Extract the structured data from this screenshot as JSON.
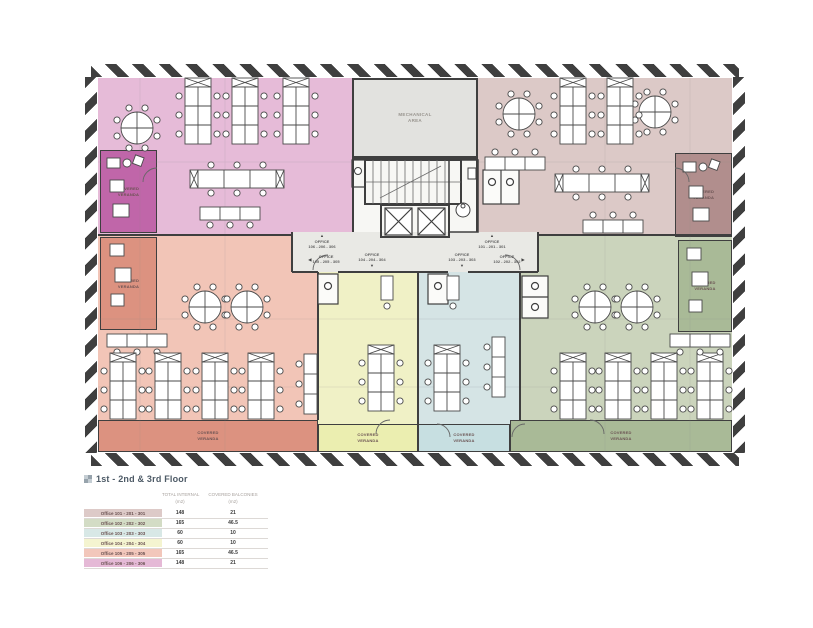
{
  "plan": {
    "mechanical_label": "MECHANICAL\nAREA",
    "veranda_label": "COVERED\nVERANDA",
    "surfaces": {
      "mechanical": "#e2e2df",
      "corridor": "#e9e9e5",
      "core": "#f7f7f4"
    },
    "zones": {
      "office101": {
        "color": "#dcc9c7",
        "veranda": "#b18e8d"
      },
      "office102": {
        "color": "#cbd4bc",
        "veranda": "#a9ba97"
      },
      "office103": {
        "color": "#d5e4e5",
        "veranda": "#c7dfe1"
      },
      "office104": {
        "color": "#f0f1c6",
        "veranda": "#ebeeb0"
      },
      "office105": {
        "color": "#f2c5b7",
        "veranda": "#dc9280"
      },
      "office106": {
        "color": "#e6bbd8",
        "veranda": "#c066a9"
      }
    },
    "directions": [
      {
        "name": "office-106",
        "text": "OFFICE\n106 - 206 - 306",
        "arrow": "▲"
      },
      {
        "name": "office-101",
        "text": "OFFICE\n101 - 201 - 301",
        "arrow": "▲"
      },
      {
        "name": "office-105",
        "text": "OFFICE\n105 - 205 - 305",
        "arrow": "◀"
      },
      {
        "name": "office-104",
        "text": "OFFICE\n104 - 204 - 304",
        "arrow": "▼"
      },
      {
        "name": "office-103",
        "text": "OFFICE\n103 - 203 - 303",
        "arrow": "▼"
      },
      {
        "name": "office-102",
        "text": "OFFICE\n102 - 202 - 302",
        "arrow": "▶"
      }
    ]
  },
  "legend": {
    "title": "1st - 2nd & 3rd Floor",
    "columns": [
      {
        "label": "TOTAL INTERNAL",
        "unit": "(m2)"
      },
      {
        "label": "COVERED BALCONIES",
        "unit": "(m2)"
      }
    ],
    "rows": [
      {
        "label": "Office 101 - 201 - 301",
        "internal": "148",
        "balconies": "21",
        "color": "#ddcac8"
      },
      {
        "label": "Office 102 - 202 - 302",
        "internal": "165",
        "balconies": "46.5",
        "color": "#d3dcc5"
      },
      {
        "label": "Office 103 - 203 - 303",
        "internal": "60",
        "balconies": "10",
        "color": "#d8e8e6"
      },
      {
        "label": "Office 104 - 204 - 304",
        "internal": "60",
        "balconies": "10",
        "color": "#f4f4d0"
      },
      {
        "label": "Office 105 - 205 - 305",
        "internal": "165",
        "balconies": "46.5",
        "color": "#f2c7bb"
      },
      {
        "label": "Office 106 - 206 - 306",
        "internal": "148",
        "balconies": "21",
        "color": "#e5b9d6"
      }
    ]
  }
}
